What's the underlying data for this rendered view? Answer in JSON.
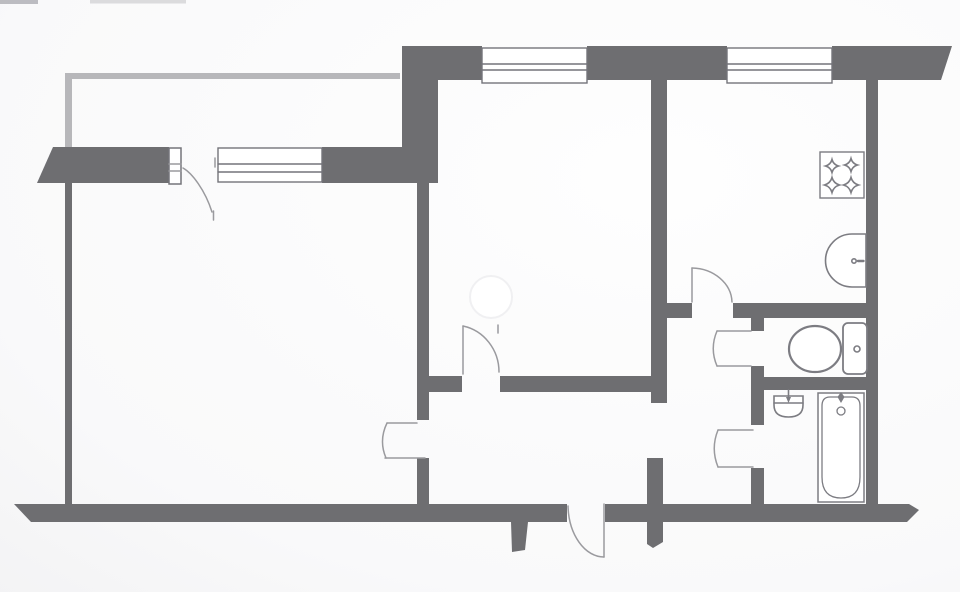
{
  "palette": {
    "wall": "#6e6e71",
    "railing": "#b7b7ba",
    "window": "#74747a",
    "door": "#9a9a9e",
    "fixture": "#7c7c82",
    "paper": "#f9f9fa",
    "watermark_fill": "#ffffff",
    "watermark_ring": "#f0f0f2"
  },
  "plan": {
    "artifacts": [
      {
        "name": "scan-smudge-top-left",
        "t": "rect",
        "x": 0,
        "y": 0,
        "w": 38,
        "h": 4,
        "f": "#b2b2b6",
        "o": 0.85
      },
      {
        "name": "scan-streak-top",
        "t": "rect",
        "x": 90,
        "y": 0,
        "w": 96,
        "h": 3.5,
        "f": "#c6c6c9",
        "o": 0.6
      }
    ],
    "balcony_railing": {
      "name": "balcony-railing",
      "t": "poly",
      "p": [
        [
          65,
          73
        ],
        [
          400,
          73
        ],
        [
          400,
          79
        ],
        [
          72,
          79
        ],
        [
          72,
          150
        ],
        [
          65,
          150
        ]
      ]
    },
    "walls": [
      {
        "name": "wall-top-left-block",
        "t": "poly",
        "p": [
          [
            402,
            46
          ],
          [
            438,
            46
          ],
          [
            438,
            182
          ],
          [
            402,
            182
          ]
        ]
      },
      {
        "name": "wall-top-a",
        "t": "poly",
        "p": [
          [
            438,
            46
          ],
          [
            482,
            46
          ],
          [
            482,
            80
          ],
          [
            438,
            80
          ]
        ]
      },
      {
        "name": "wall-top-between-windows",
        "t": "poly",
        "p": [
          [
            587,
            46
          ],
          [
            727,
            46
          ],
          [
            727,
            80
          ],
          [
            587,
            80
          ]
        ]
      },
      {
        "name": "wall-top-right-broken-end",
        "t": "poly",
        "p": [
          [
            832,
            46
          ],
          [
            952,
            46
          ],
          [
            941,
            80
          ],
          [
            832,
            80
          ]
        ]
      },
      {
        "name": "wall-living-top-left-broken-end",
        "t": "poly",
        "p": [
          [
            53,
            147
          ],
          [
            169,
            147
          ],
          [
            169,
            183
          ],
          [
            37,
            183
          ]
        ]
      },
      {
        "name": "wall-living-top-right",
        "t": "poly",
        "p": [
          [
            322,
            147
          ],
          [
            438,
            147
          ],
          [
            438,
            183
          ],
          [
            322,
            183
          ]
        ]
      },
      {
        "name": "wall-outer-left",
        "t": "poly",
        "p": [
          [
            65,
            147
          ],
          [
            72,
            147
          ],
          [
            72,
            522
          ],
          [
            65,
            522
          ]
        ]
      },
      {
        "name": "wall-bottom-left-broken-end",
        "t": "poly",
        "p": [
          [
            14,
            504
          ],
          [
            567,
            504
          ],
          [
            567,
            522
          ],
          [
            31,
            522
          ]
        ]
      },
      {
        "name": "wall-bottom-right-broken-end",
        "t": "poly",
        "p": [
          [
            605,
            504
          ],
          [
            909,
            504
          ],
          [
            919,
            510
          ],
          [
            907,
            522
          ],
          [
            605,
            522
          ]
        ]
      },
      {
        "name": "wall-bedroom-left",
        "t": "poly",
        "p": [
          [
            417,
            182
          ],
          [
            429,
            182
          ],
          [
            429,
            420
          ],
          [
            417,
            420
          ]
        ]
      },
      {
        "name": "wall-bedroom-left-stub",
        "t": "poly",
        "p": [
          [
            417,
            458
          ],
          [
            429,
            458
          ],
          [
            429,
            506
          ],
          [
            417,
            506
          ]
        ]
      },
      {
        "name": "wall-bedroom-bottom-left",
        "t": "poly",
        "p": [
          [
            429,
            376
          ],
          [
            462,
            376
          ],
          [
            462,
            392
          ],
          [
            429,
            392
          ]
        ]
      },
      {
        "name": "wall-bedroom-bottom-right",
        "t": "poly",
        "p": [
          [
            500,
            376
          ],
          [
            652,
            376
          ],
          [
            652,
            392
          ],
          [
            500,
            392
          ]
        ]
      },
      {
        "name": "wall-center-column",
        "t": "poly",
        "p": [
          [
            651,
            60
          ],
          [
            667,
            60
          ],
          [
            667,
            403
          ],
          [
            651,
            403
          ]
        ]
      },
      {
        "name": "wall-corridor-cross-stub",
        "t": "poly",
        "p": [
          [
            647,
            458
          ],
          [
            663,
            458
          ],
          [
            663,
            542
          ],
          [
            653,
            548
          ],
          [
            647,
            544
          ]
        ]
      },
      {
        "name": "wall-entrance-stub",
        "t": "poly",
        "p": [
          [
            511,
            522
          ],
          [
            528,
            522
          ],
          [
            525,
            550
          ],
          [
            512,
            552
          ]
        ]
      },
      {
        "name": "wall-kitchen-bottom-left",
        "t": "poly",
        "p": [
          [
            651,
            303
          ],
          [
            692,
            303
          ],
          [
            692,
            318
          ],
          [
            651,
            318
          ]
        ]
      },
      {
        "name": "wall-kitchen-bottom-right",
        "t": "poly",
        "p": [
          [
            733,
            303
          ],
          [
            878,
            303
          ],
          [
            878,
            318
          ],
          [
            733,
            318
          ]
        ]
      },
      {
        "name": "wall-wc-left-top-stub",
        "t": "poly",
        "p": [
          [
            751,
            318
          ],
          [
            764,
            318
          ],
          [
            764,
            331
          ],
          [
            751,
            331
          ]
        ]
      },
      {
        "name": "wall-wc-left-bottom-stub",
        "t": "poly",
        "p": [
          [
            751,
            366
          ],
          [
            764,
            366
          ],
          [
            764,
            378
          ],
          [
            751,
            378
          ]
        ]
      },
      {
        "name": "wall-wc-bath-divider",
        "t": "poly",
        "p": [
          [
            751,
            377
          ],
          [
            878,
            377
          ],
          [
            878,
            390
          ],
          [
            751,
            390
          ]
        ]
      },
      {
        "name": "wall-bath-left-top-stub",
        "t": "poly",
        "p": [
          [
            751,
            390
          ],
          [
            764,
            390
          ],
          [
            764,
            425
          ],
          [
            751,
            425
          ]
        ]
      },
      {
        "name": "wall-bath-left-bottom-stub",
        "t": "poly",
        "p": [
          [
            751,
            468
          ],
          [
            764,
            468
          ],
          [
            764,
            504
          ],
          [
            751,
            504
          ]
        ]
      },
      {
        "name": "wall-outer-right",
        "t": "poly",
        "p": [
          [
            866,
            80
          ],
          [
            878,
            80
          ],
          [
            878,
            504
          ],
          [
            866,
            504
          ]
        ]
      }
    ],
    "windows": [
      {
        "name": "living-room-window",
        "shapes": [
          {
            "t": "rect",
            "x": 218,
            "y": 148,
            "w": 104,
            "h": 34,
            "f": "#ffffff"
          },
          {
            "t": "line",
            "x1": 218,
            "y1": 164,
            "x2": 322,
            "y2": 164
          },
          {
            "t": "line",
            "x1": 218,
            "y1": 172,
            "x2": 322,
            "y2": 172
          }
        ]
      },
      {
        "name": "bedroom-window",
        "shapes": [
          {
            "t": "rect",
            "x": 482,
            "y": 48,
            "w": 105,
            "h": 35,
            "f": "#ffffff"
          },
          {
            "t": "line",
            "x1": 482,
            "y1": 64,
            "x2": 587,
            "y2": 64
          },
          {
            "t": "line",
            "x1": 482,
            "y1": 70,
            "x2": 587,
            "y2": 70
          }
        ]
      },
      {
        "name": "kitchen-window",
        "shapes": [
          {
            "t": "rect",
            "x": 727,
            "y": 48,
            "w": 105,
            "h": 35,
            "f": "#ffffff"
          },
          {
            "t": "line",
            "x1": 727,
            "y1": 64,
            "x2": 832,
            "y2": 64
          },
          {
            "t": "line",
            "x1": 727,
            "y1": 70,
            "x2": 832,
            "y2": 70
          }
        ]
      }
    ],
    "doors": [
      {
        "name": "balcony-door",
        "shapes": [
          {
            "t": "rect",
            "x": 169,
            "y": 148,
            "w": 12,
            "h": 36,
            "f": "#ffffff",
            "s": "window"
          },
          {
            "t": "line",
            "x1": 169,
            "y1": 164,
            "x2": 181,
            "y2": 164
          },
          {
            "t": "line",
            "x1": 169,
            "y1": 171,
            "x2": 181,
            "y2": 171
          },
          {
            "t": "path",
            "d": "M183,168 C192,173 205,190 212,212"
          },
          {
            "t": "line",
            "x1": 213.5,
            "y1": 211,
            "x2": 213.5,
            "y2": 220
          },
          {
            "t": "line",
            "x1": 215,
            "y1": 158,
            "x2": 215,
            "y2": 167
          }
        ]
      },
      {
        "name": "living-room-door",
        "shapes": [
          {
            "t": "line",
            "x1": 387,
            "y1": 423,
            "x2": 417,
            "y2": 423
          },
          {
            "t": "line",
            "x1": 385,
            "y1": 458,
            "x2": 425,
            "y2": 458
          },
          {
            "t": "path",
            "d": "M387,423 Q378.5,440.5 386,458"
          }
        ]
      },
      {
        "name": "bedroom-door",
        "shapes": [
          {
            "t": "line",
            "x1": 463,
            "y1": 326,
            "x2": 463,
            "y2": 374
          },
          {
            "t": "line",
            "x1": 498,
            "y1": 325,
            "x2": 498,
            "y2": 333
          },
          {
            "t": "path",
            "d": "M463,326 A45,47 0 0 1 499,372"
          }
        ]
      },
      {
        "name": "kitchen-door",
        "shapes": [
          {
            "t": "line",
            "x1": 692,
            "y1": 268,
            "x2": 692,
            "y2": 302
          },
          {
            "t": "path",
            "d": "M692,268 A41,35 0 0 1 732,302"
          }
        ]
      },
      {
        "name": "wc-door",
        "shapes": [
          {
            "t": "line",
            "x1": 717,
            "y1": 331,
            "x2": 751,
            "y2": 331
          },
          {
            "t": "line",
            "x1": 717,
            "y1": 366,
            "x2": 751,
            "y2": 366
          },
          {
            "t": "path",
            "d": "M717,331 Q709.5,348.5 717,366"
          }
        ]
      },
      {
        "name": "bathroom-door",
        "shapes": [
          {
            "t": "line",
            "x1": 718,
            "y1": 430,
            "x2": 753,
            "y2": 430
          },
          {
            "t": "line",
            "x1": 718,
            "y1": 467,
            "x2": 753,
            "y2": 467
          },
          {
            "t": "path",
            "d": "M718,430 Q710.5,448.5 718,467"
          }
        ]
      },
      {
        "name": "entrance-door",
        "shapes": [
          {
            "t": "line",
            "x1": 604,
            "y1": 504,
            "x2": 604,
            "y2": 557
          },
          {
            "t": "path",
            "d": "M568,506 A36,53 0 0 0 604,557"
          }
        ]
      }
    ],
    "fixtures": [
      {
        "name": "stove",
        "shapes": [
          {
            "t": "rect",
            "x": 820,
            "y": 152,
            "w": 44,
            "h": 46,
            "f": "#ffffff",
            "w2": 1.4
          },
          {
            "t": "star",
            "cx": 832,
            "cy": 166,
            "r": 6.5
          },
          {
            "t": "star",
            "cx": 851,
            "cy": 165,
            "r": 6.5
          },
          {
            "t": "star",
            "cx": 832,
            "cy": 185,
            "r": 7.5
          },
          {
            "t": "star",
            "cx": 851,
            "cy": 185,
            "r": 7.5
          }
        ]
      },
      {
        "name": "kitchen-sink",
        "shapes": [
          {
            "t": "path",
            "d": "M852,234 L866,234 L866,287 L852,287 A26.5,26.5 0 0 1 852,234 Z",
            "f": "#ffffff"
          },
          {
            "t": "circle",
            "cx": 854,
            "cy": 261,
            "r": 2.2
          },
          {
            "t": "line",
            "x1": 858,
            "y1": 261,
            "x2": 863.5,
            "y2": 261,
            "w2": 2.4
          }
        ]
      },
      {
        "name": "toilet",
        "shapes": [
          {
            "t": "ellipse",
            "cx": 815,
            "cy": 349,
            "rx": 26,
            "ry": 23,
            "f": "#ffffff",
            "w2": 2.2
          },
          {
            "t": "rect",
            "x": 843,
            "y": 323,
            "w": 24,
            "h": 51,
            "rx": 5,
            "f": "#ffffff",
            "w2": 1.8
          },
          {
            "t": "circle",
            "cx": 857,
            "cy": 349,
            "r": 3
          }
        ]
      },
      {
        "name": "bathroom-sink",
        "shapes": [
          {
            "t": "path",
            "d": "M774,396 L803,396 L803,405 Q803,417 788.5,417 Q774,417 774,405 Z",
            "f": "#ffffff"
          },
          {
            "t": "line",
            "x1": 774,
            "y1": 403,
            "x2": 803,
            "y2": 403
          },
          {
            "t": "line",
            "x1": 788.5,
            "y1": 390,
            "x2": 788.5,
            "y2": 397
          },
          {
            "t": "poly",
            "p": [
              [
                786,
                397
              ],
              [
                791,
                397
              ],
              [
                788.5,
                403
              ]
            ],
            "f": "fixture",
            "s": "none"
          }
        ]
      },
      {
        "name": "bathtub",
        "shapes": [
          {
            "t": "rect",
            "x": 818,
            "y": 393,
            "w": 46,
            "h": 109,
            "f": "#ffffff",
            "w2": 1.5
          },
          {
            "t": "path",
            "d": "M830,397 L852,397 Q860,397 860,406 L860,477 Q860,498 841,498 Q822,498 822,477 L822,406 Q822,397 830,397 Z",
            "w2": 1.3
          },
          {
            "t": "circle",
            "cx": 841,
            "cy": 411,
            "r": 4,
            "w2": 1.3
          },
          {
            "t": "poly",
            "p": [
              [
                841,
                392
              ],
              [
                837.5,
                397
              ],
              [
                841,
                403
              ],
              [
                844.5,
                397
              ]
            ],
            "f": "fixture",
            "s": "none"
          }
        ]
      }
    ],
    "watermark": {
      "name": "watermark-circle",
      "t": "circle",
      "cx": 491,
      "cy": 297,
      "r": 21,
      "f": "#ffffff",
      "s": "#f0f0f2",
      "w2": 2
    }
  }
}
